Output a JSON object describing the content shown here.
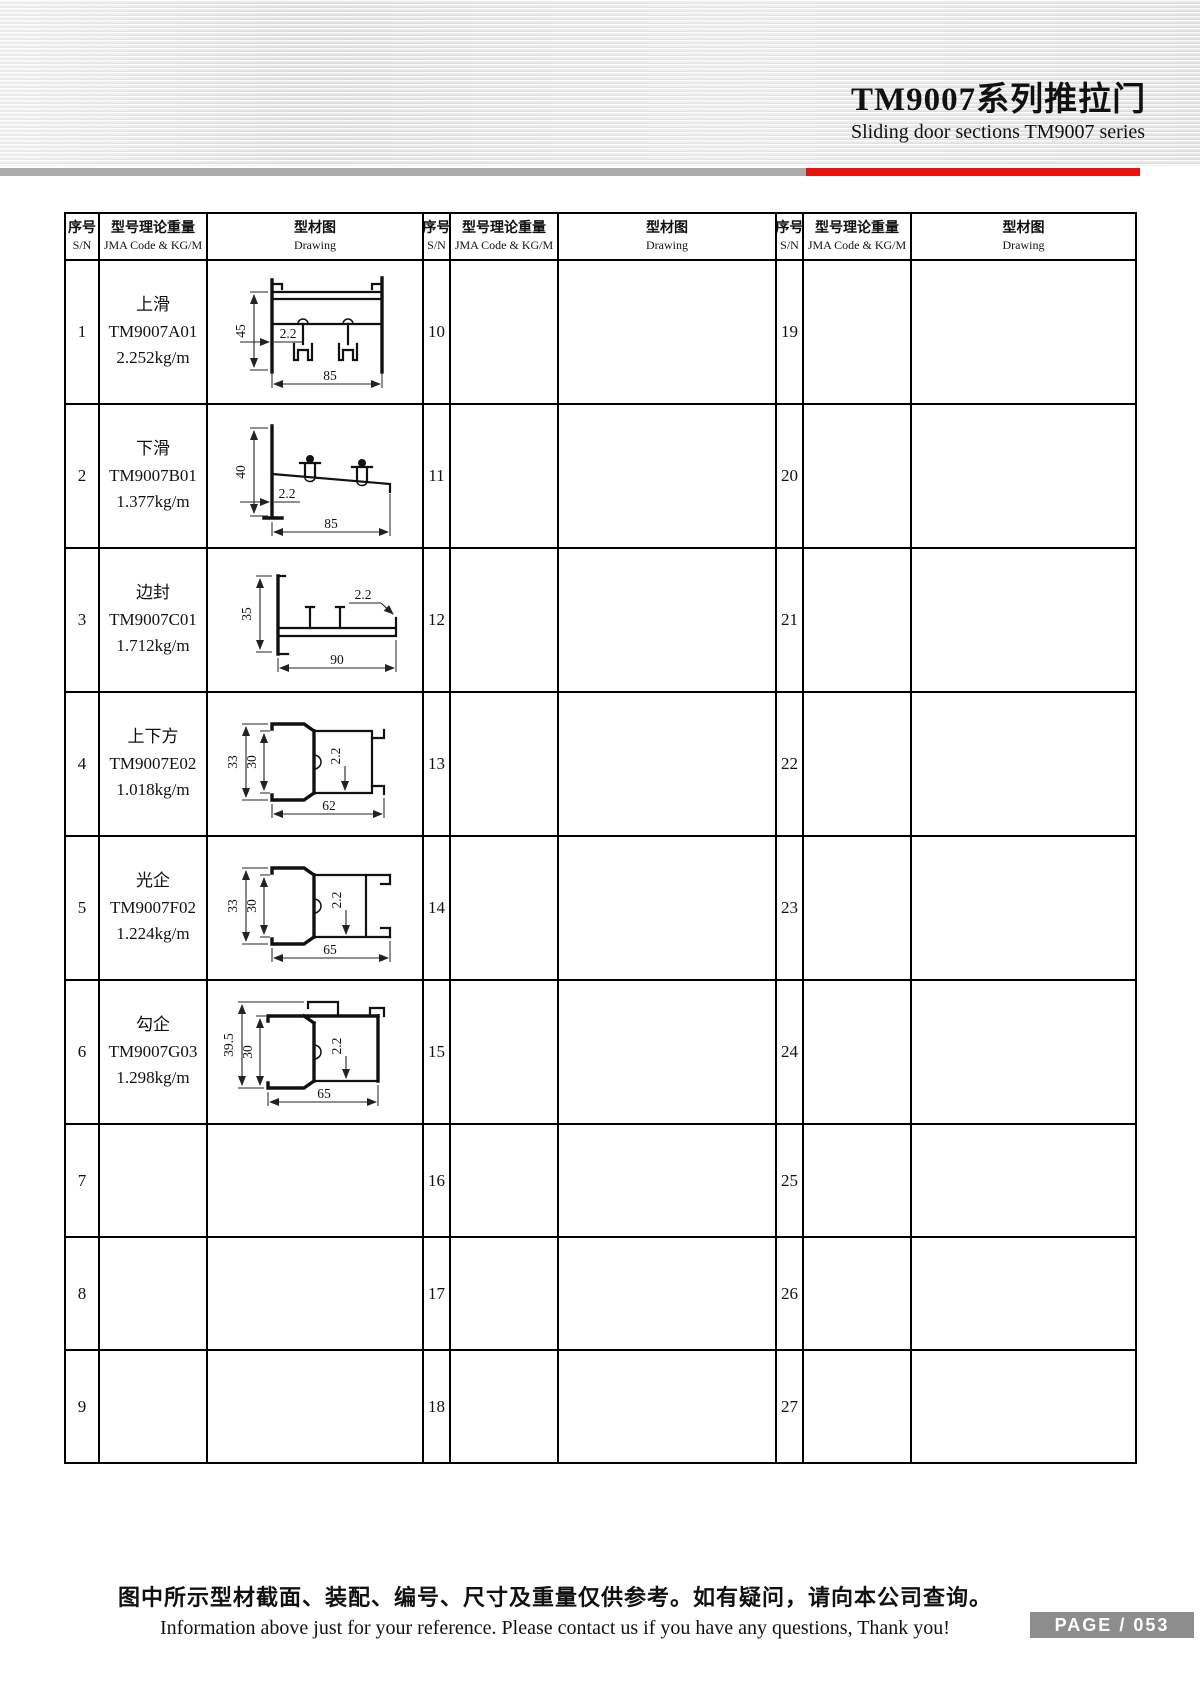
{
  "page": {
    "header": {
      "title_cn": "TM9007系列推拉门",
      "title_en": "Sliding door sections TM9007 series"
    },
    "footer": {
      "note_cn": "图中所示型材截面、装配、编号、尺寸及重量仅供参考。如有疑问，请向本公司查询。",
      "note_en": "Information above just for your reference. Please contact us if you have any questions, Thank you!",
      "page_label": "PAGE / 053"
    },
    "colors": {
      "accent_red": "#e8140c",
      "bar_gray": "#ababab",
      "badge_gray": "#8d8d8d"
    }
  },
  "table": {
    "headers": {
      "sn_cn": "序号",
      "sn_en": "S/N",
      "code_cn": "型号理论重量",
      "code_en": "JMA Code & KG/M",
      "drawing_cn": "型材图",
      "drawing_en": "Drawing"
    },
    "groups": [
      {
        "sns": [
          "1",
          "2",
          "3",
          "4",
          "5",
          "6",
          "7",
          "8",
          "9"
        ]
      },
      {
        "sns": [
          "10",
          "11",
          "12",
          "13",
          "14",
          "15",
          "16",
          "17",
          "18"
        ]
      },
      {
        "sns": [
          "19",
          "20",
          "21",
          "22",
          "23",
          "24",
          "25",
          "26",
          "27"
        ]
      }
    ],
    "profiles": [
      {
        "sn": "1",
        "name": "上滑",
        "code": "TM9007A01",
        "weight": "2.252kg/m",
        "dims": {
          "height": "45",
          "thk": "2.2",
          "width": "85"
        }
      },
      {
        "sn": "2",
        "name": "下滑",
        "code": "TM9007B01",
        "weight": "1.377kg/m",
        "dims": {
          "height": "40",
          "thk": "2.2",
          "width": "85"
        }
      },
      {
        "sn": "3",
        "name": "边封",
        "code": "TM9007C01",
        "weight": "1.712kg/m",
        "dims": {
          "height": "35",
          "thk": "2.2",
          "width": "90"
        }
      },
      {
        "sn": "4",
        "name": "上下方",
        "code": "TM9007E02",
        "weight": "1.018kg/m",
        "dims": {
          "height": "33",
          "inner": "30",
          "thk": "2.2",
          "width": "62"
        }
      },
      {
        "sn": "5",
        "name": "光企",
        "code": "TM9007F02",
        "weight": "1.224kg/m",
        "dims": {
          "height": "33",
          "inner": "30",
          "thk": "2.2",
          "width": "65"
        }
      },
      {
        "sn": "6",
        "name": "勾企",
        "code": "TM9007G03",
        "weight": "1.298kg/m",
        "dims": {
          "height": "39.5",
          "inner": "30",
          "thk": "2.2",
          "width": "65"
        }
      }
    ]
  }
}
